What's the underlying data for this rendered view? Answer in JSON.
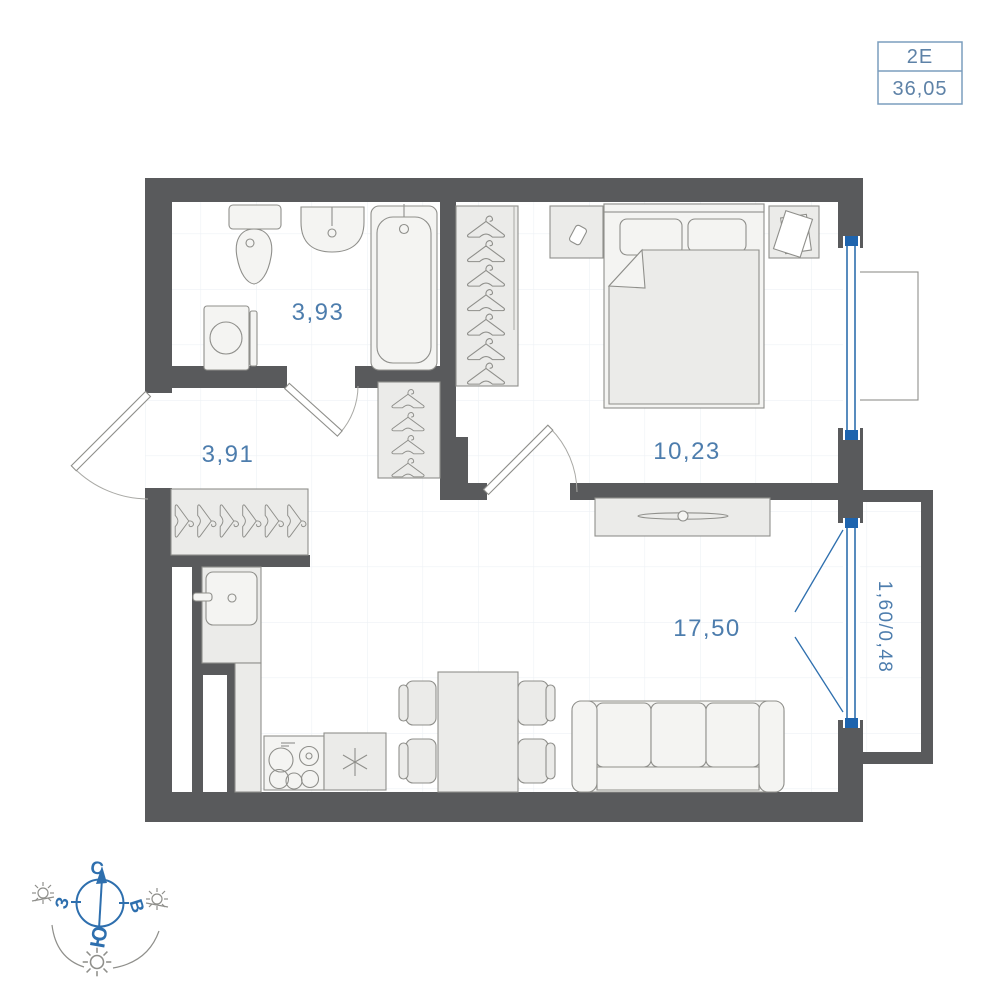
{
  "unit_card": {
    "type_label": "2Е",
    "area_value": "36,05"
  },
  "rooms": {
    "bathroom": {
      "name": "bathroom",
      "area": "3,93"
    },
    "hallway": {
      "name": "hallway",
      "area": "3,91"
    },
    "bedroom": {
      "name": "bedroom",
      "area": "10,23"
    },
    "living_kitchen": {
      "name": "living-kitchen",
      "area": "17,50"
    },
    "balcony": {
      "name": "balcony",
      "area": "1,60/0,48"
    }
  },
  "compass": {
    "north": "С",
    "west": "З",
    "east": "В",
    "south": "Ю"
  },
  "colors": {
    "wall": "#595a5c",
    "window_accent": "#2e6fae",
    "label_text": "#4d7dad",
    "card_border": "#7b9dbd",
    "furniture_fill": "#ebebe9",
    "furniture_stroke": "#8f8f8b"
  }
}
